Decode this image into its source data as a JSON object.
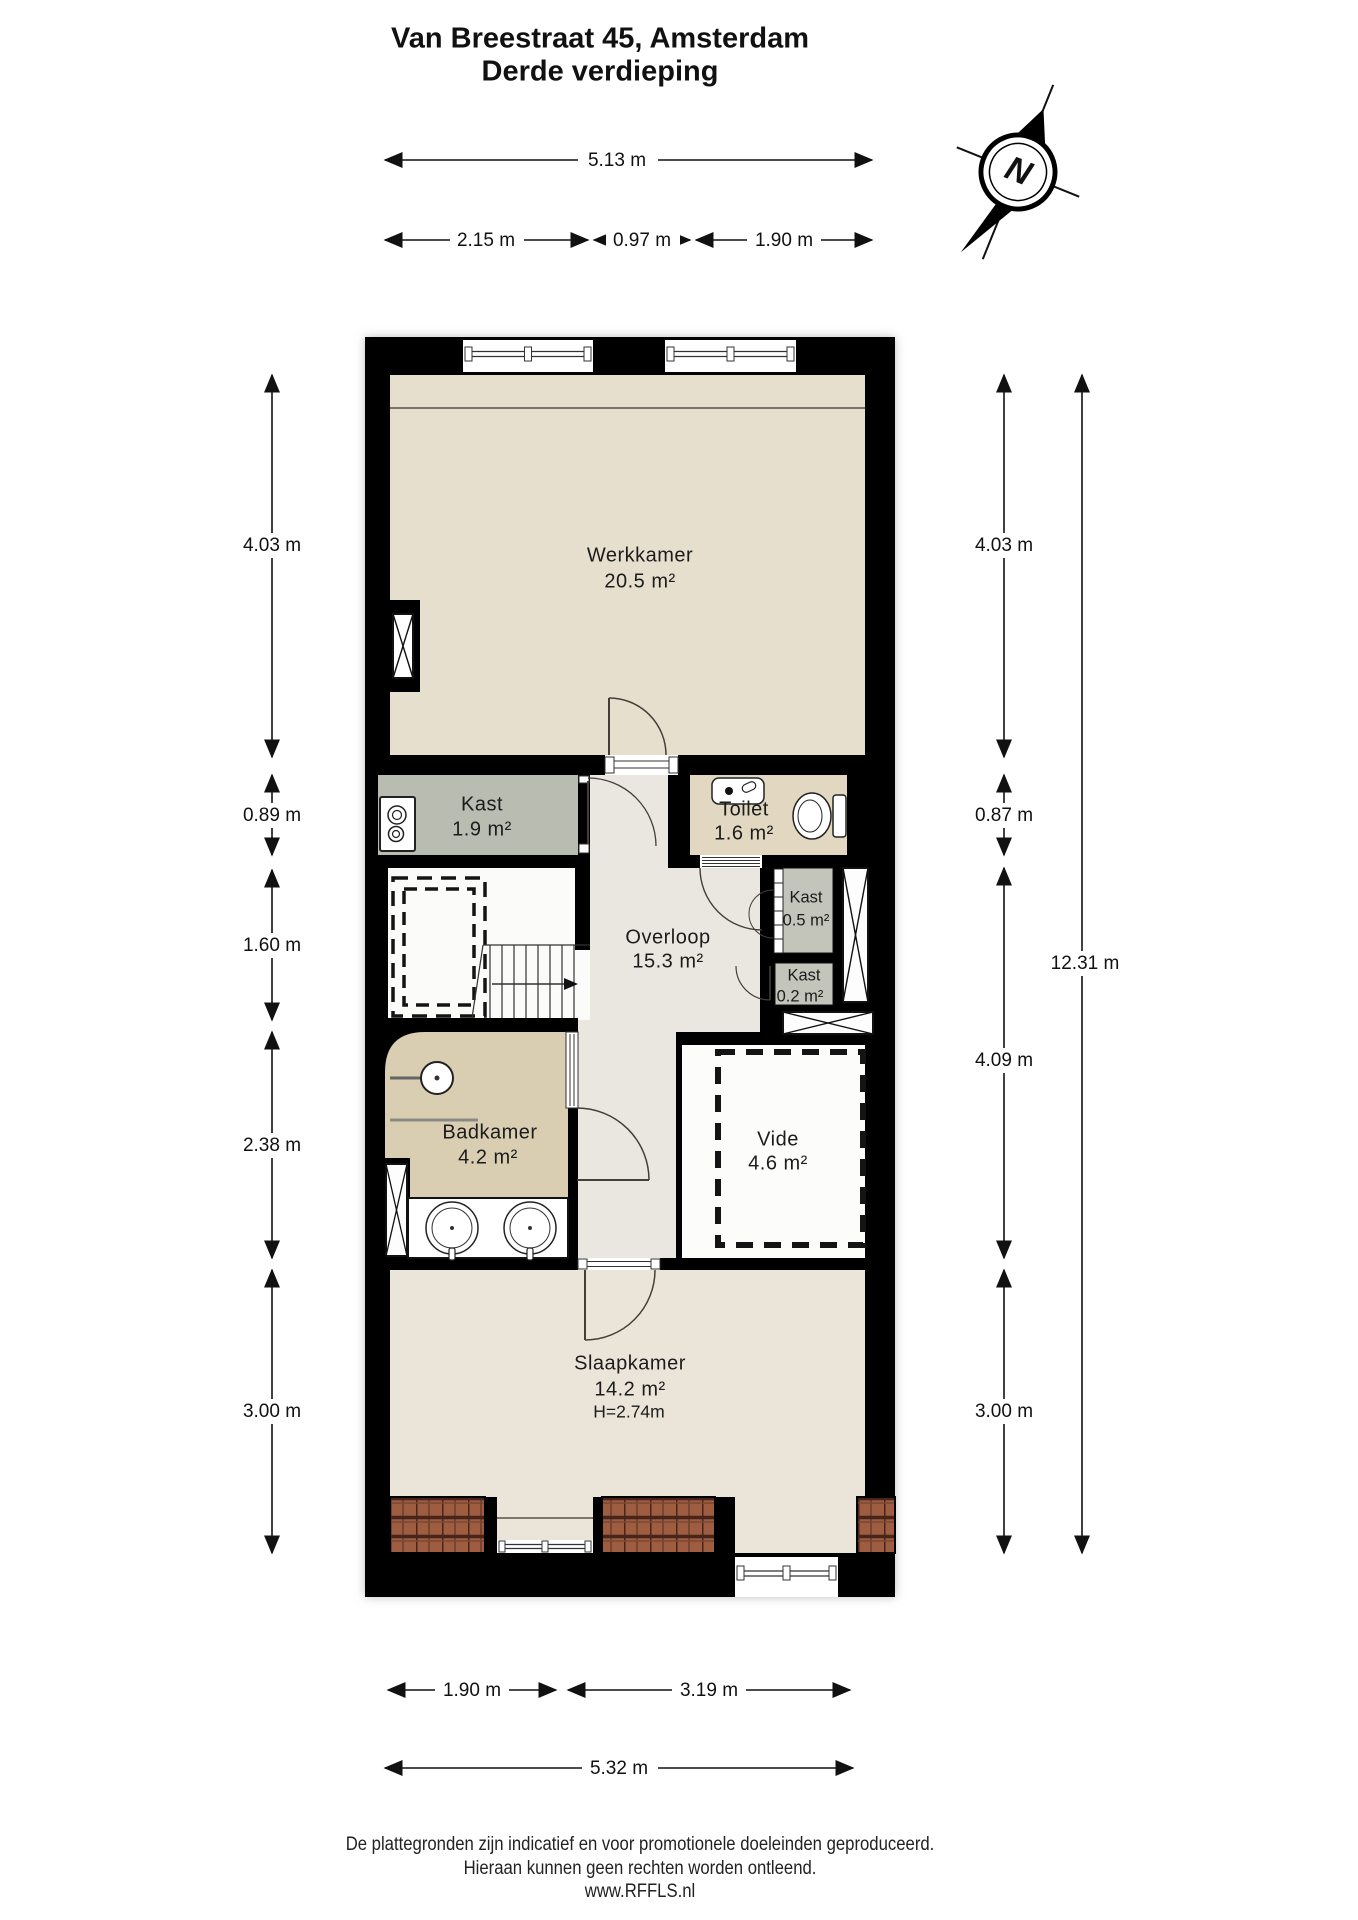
{
  "title": {
    "line1": "Van Breestraat 45, Amsterdam",
    "line2": "Derde verdieping"
  },
  "compass": {
    "north_label": "N"
  },
  "rooms": {
    "werkkamer": {
      "name": "Werkkamer",
      "area": "20.5 m²"
    },
    "kast_groot": {
      "name": "Kast",
      "area": "1.9 m²"
    },
    "toilet": {
      "name": "Toilet",
      "area": "1.6 m²"
    },
    "overloop": {
      "name": "Overloop",
      "area": "15.3 m²"
    },
    "kast_05": {
      "name": "Kast",
      "area": "0.5 m²"
    },
    "kast_02": {
      "name": "Kast",
      "area": "0.2 m²"
    },
    "badkamer": {
      "name": "Badkamer",
      "area": "4.2 m²"
    },
    "vide": {
      "name": "Vide",
      "area": "4.6 m²"
    },
    "slaapkamer": {
      "name": "Slaapkamer",
      "area": "14.2 m²",
      "height": "H=2.74m"
    }
  },
  "dimensions": {
    "top_total": "5.13 m",
    "top_seg1": "2.15 m",
    "top_seg2": "0.97 m",
    "top_seg3": "1.90 m",
    "left1": "4.03 m",
    "left2": "0.89 m",
    "left3": "1.60 m",
    "left4": "2.38 m",
    "left5": "3.00 m",
    "right1": "4.03 m",
    "right2": "0.87 m",
    "right3": "4.09 m",
    "right4": "3.00 m",
    "right_total": "12.31 m",
    "bottom_seg1": "1.90 m",
    "bottom_seg2": "3.19 m",
    "bottom_total": "5.32 m"
  },
  "footer": {
    "line1": "De plattegronden zijn indicatief en voor promotionele doeleinden geproduceerd.",
    "line2": "Hieraan kunnen geen rechten worden ontleend.",
    "line3": "www.RFFLS.nl"
  },
  "colors": {
    "wall": "#000000",
    "werkkamer_floor": "#e6dfce",
    "slaapkamer_floor": "#eae5d8",
    "kast_floor": "#b9bcb0",
    "kast_small_floor": "#c3c5ba",
    "toilet_floor": "#e2d8c2",
    "badkamer_floor": "#d9cdb2",
    "overloop_floor": "#e9e7e0",
    "vide_floor": "#fcfcfb",
    "roof_tile": "#9e5c41",
    "roof_tile_dark": "#46261a"
  }
}
